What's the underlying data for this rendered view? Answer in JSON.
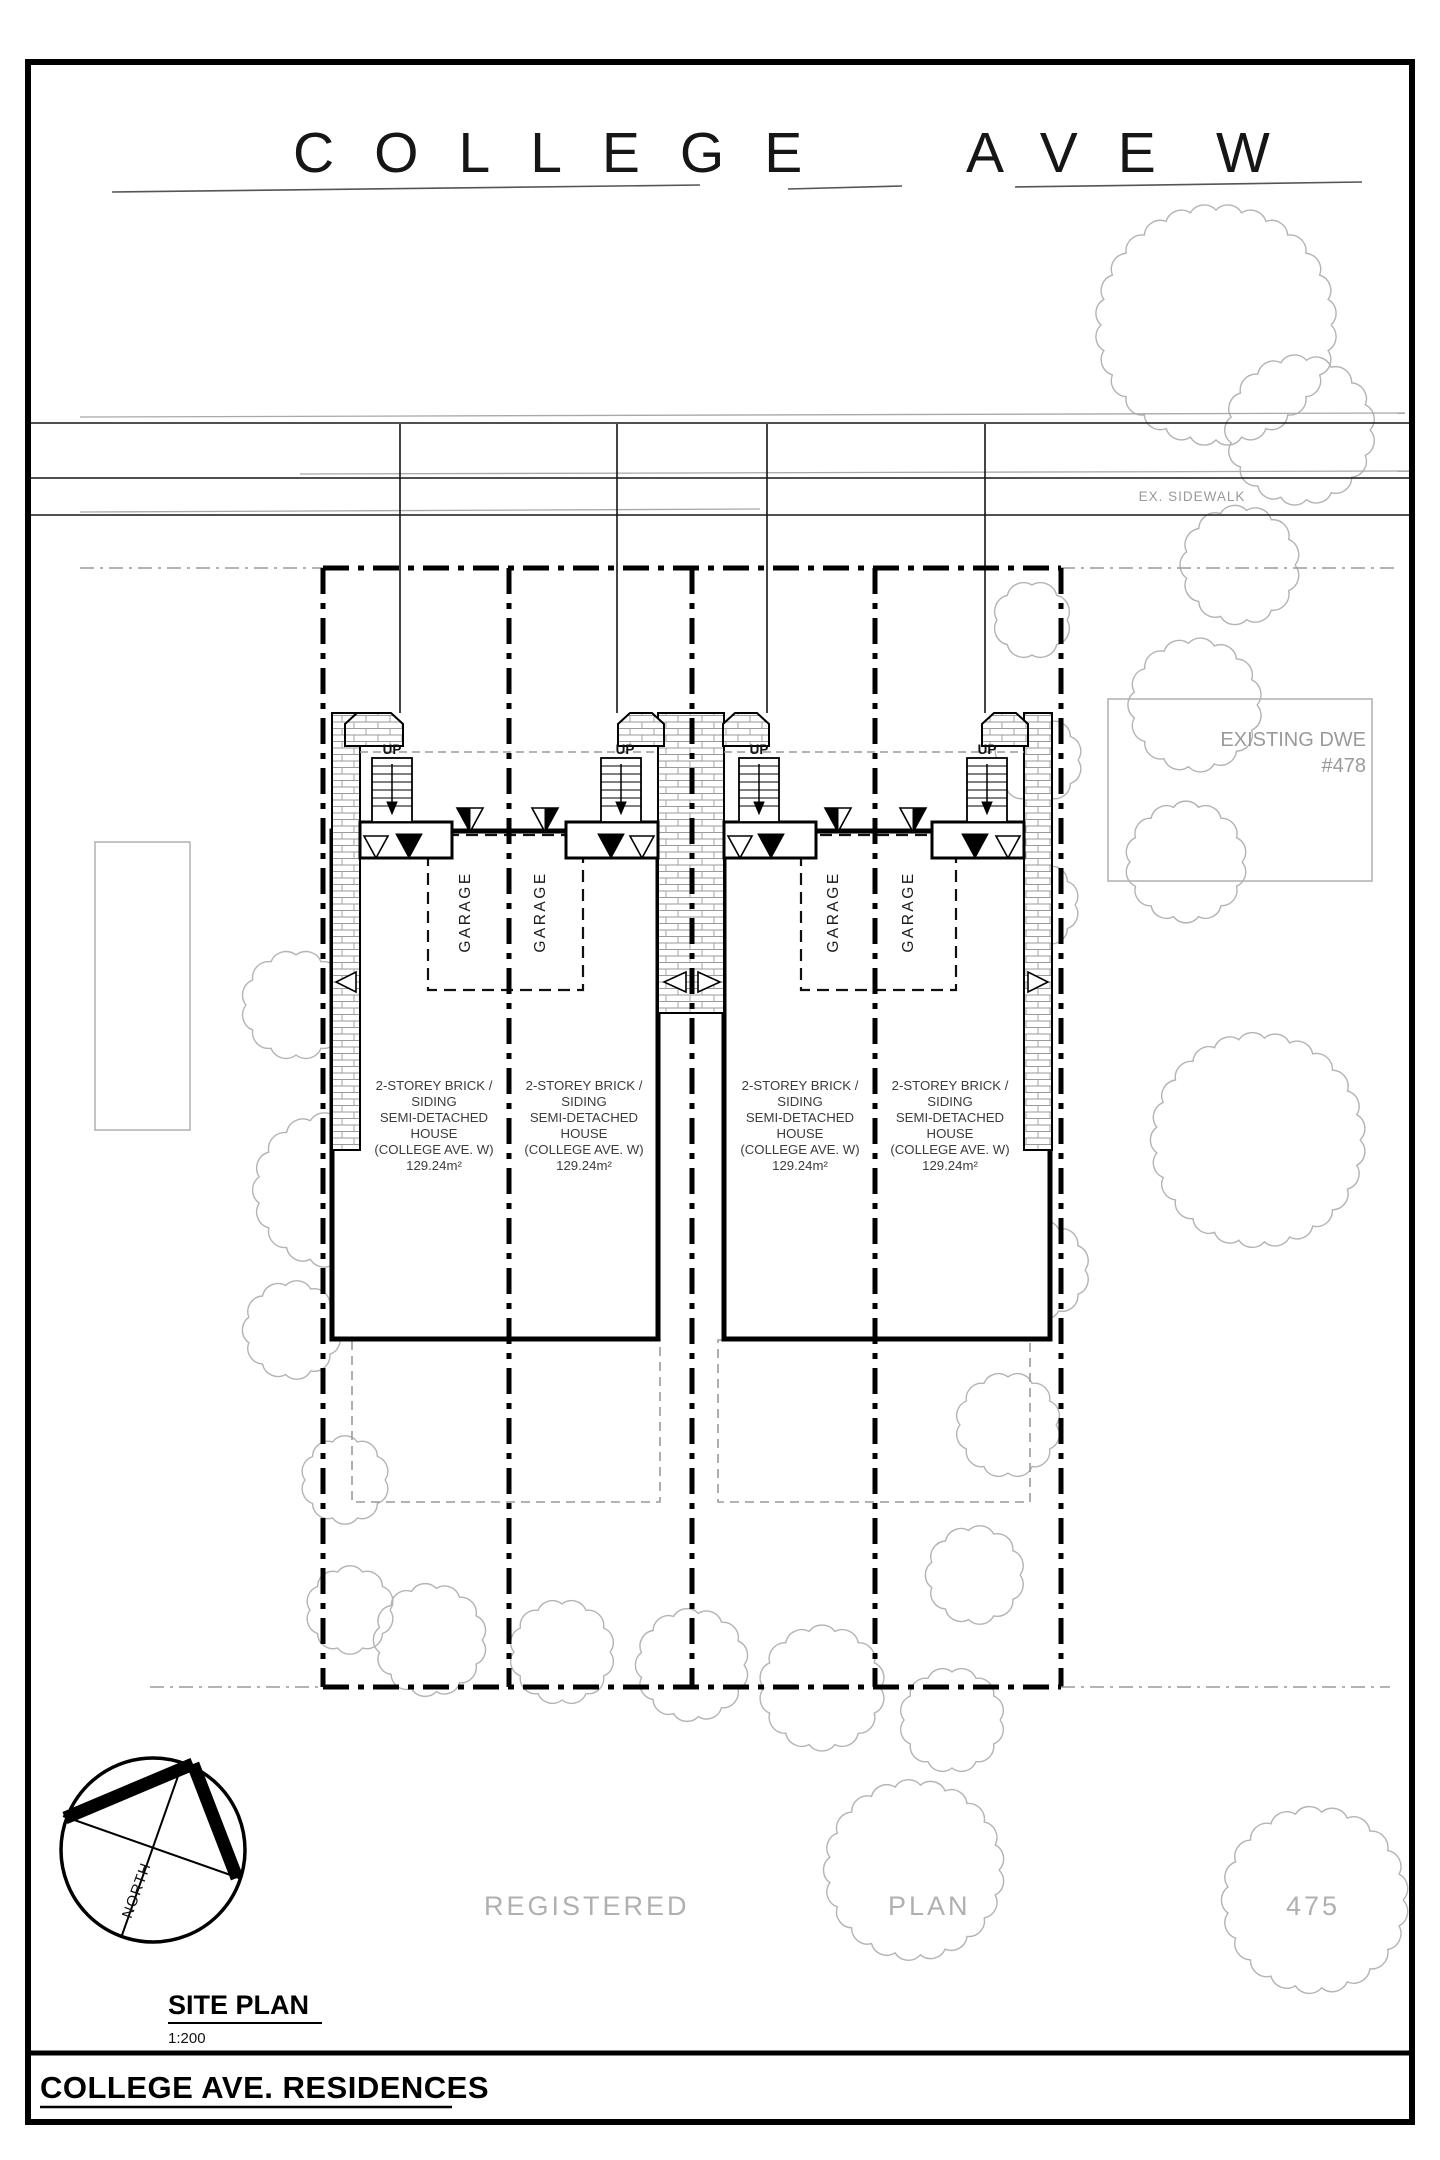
{
  "street": {
    "name_part1": "COLLEGE",
    "name_part2": "AVE",
    "name_part3": "W",
    "sidewalk_label": "EX. SIDEWALK"
  },
  "site": {
    "registered_plan_word1": "REGISTERED",
    "registered_plan_word2": "PLAN",
    "registered_plan_number": "475",
    "existing_dwelling_line1": "EXISTING DWE",
    "existing_dwelling_line2": "#478"
  },
  "units": [
    {
      "up": "UP",
      "garage": "GARAGE",
      "desc": [
        "2-STOREY BRICK /",
        "SIDING",
        "SEMI-DETACHED",
        "HOUSE",
        "(COLLEGE AVE. W)",
        "129.24m²"
      ]
    },
    {
      "up": "UP",
      "garage": "GARAGE",
      "desc": [
        "2-STOREY BRICK /",
        "SIDING",
        "SEMI-DETACHED",
        "HOUSE",
        "(COLLEGE AVE. W)",
        "129.24m²"
      ]
    },
    {
      "up": "UP",
      "garage": "GARAGE",
      "desc": [
        "2-STOREY BRICK /",
        "SIDING",
        "SEMI-DETACHED",
        "HOUSE",
        "(COLLEGE AVE. W)",
        "129.24m²"
      ]
    },
    {
      "up": "UP",
      "garage": "GARAGE",
      "desc": [
        "2-STOREY BRICK /",
        "SIDING",
        "SEMI-DETACHED",
        "HOUSE",
        "(COLLEGE AVE. W)",
        "129.24m²"
      ]
    }
  ],
  "compass": {
    "label": "NORTH"
  },
  "title_block": {
    "drawing_title": "SITE PLAN",
    "scale": "1:200",
    "project_title": "COLLEGE AVE. RESIDENCES"
  },
  "colors": {
    "line": "#000000",
    "secondary_gray": "#9a9a9a",
    "tree_gray": "#b4b4b4",
    "paper": "#ffffff"
  }
}
